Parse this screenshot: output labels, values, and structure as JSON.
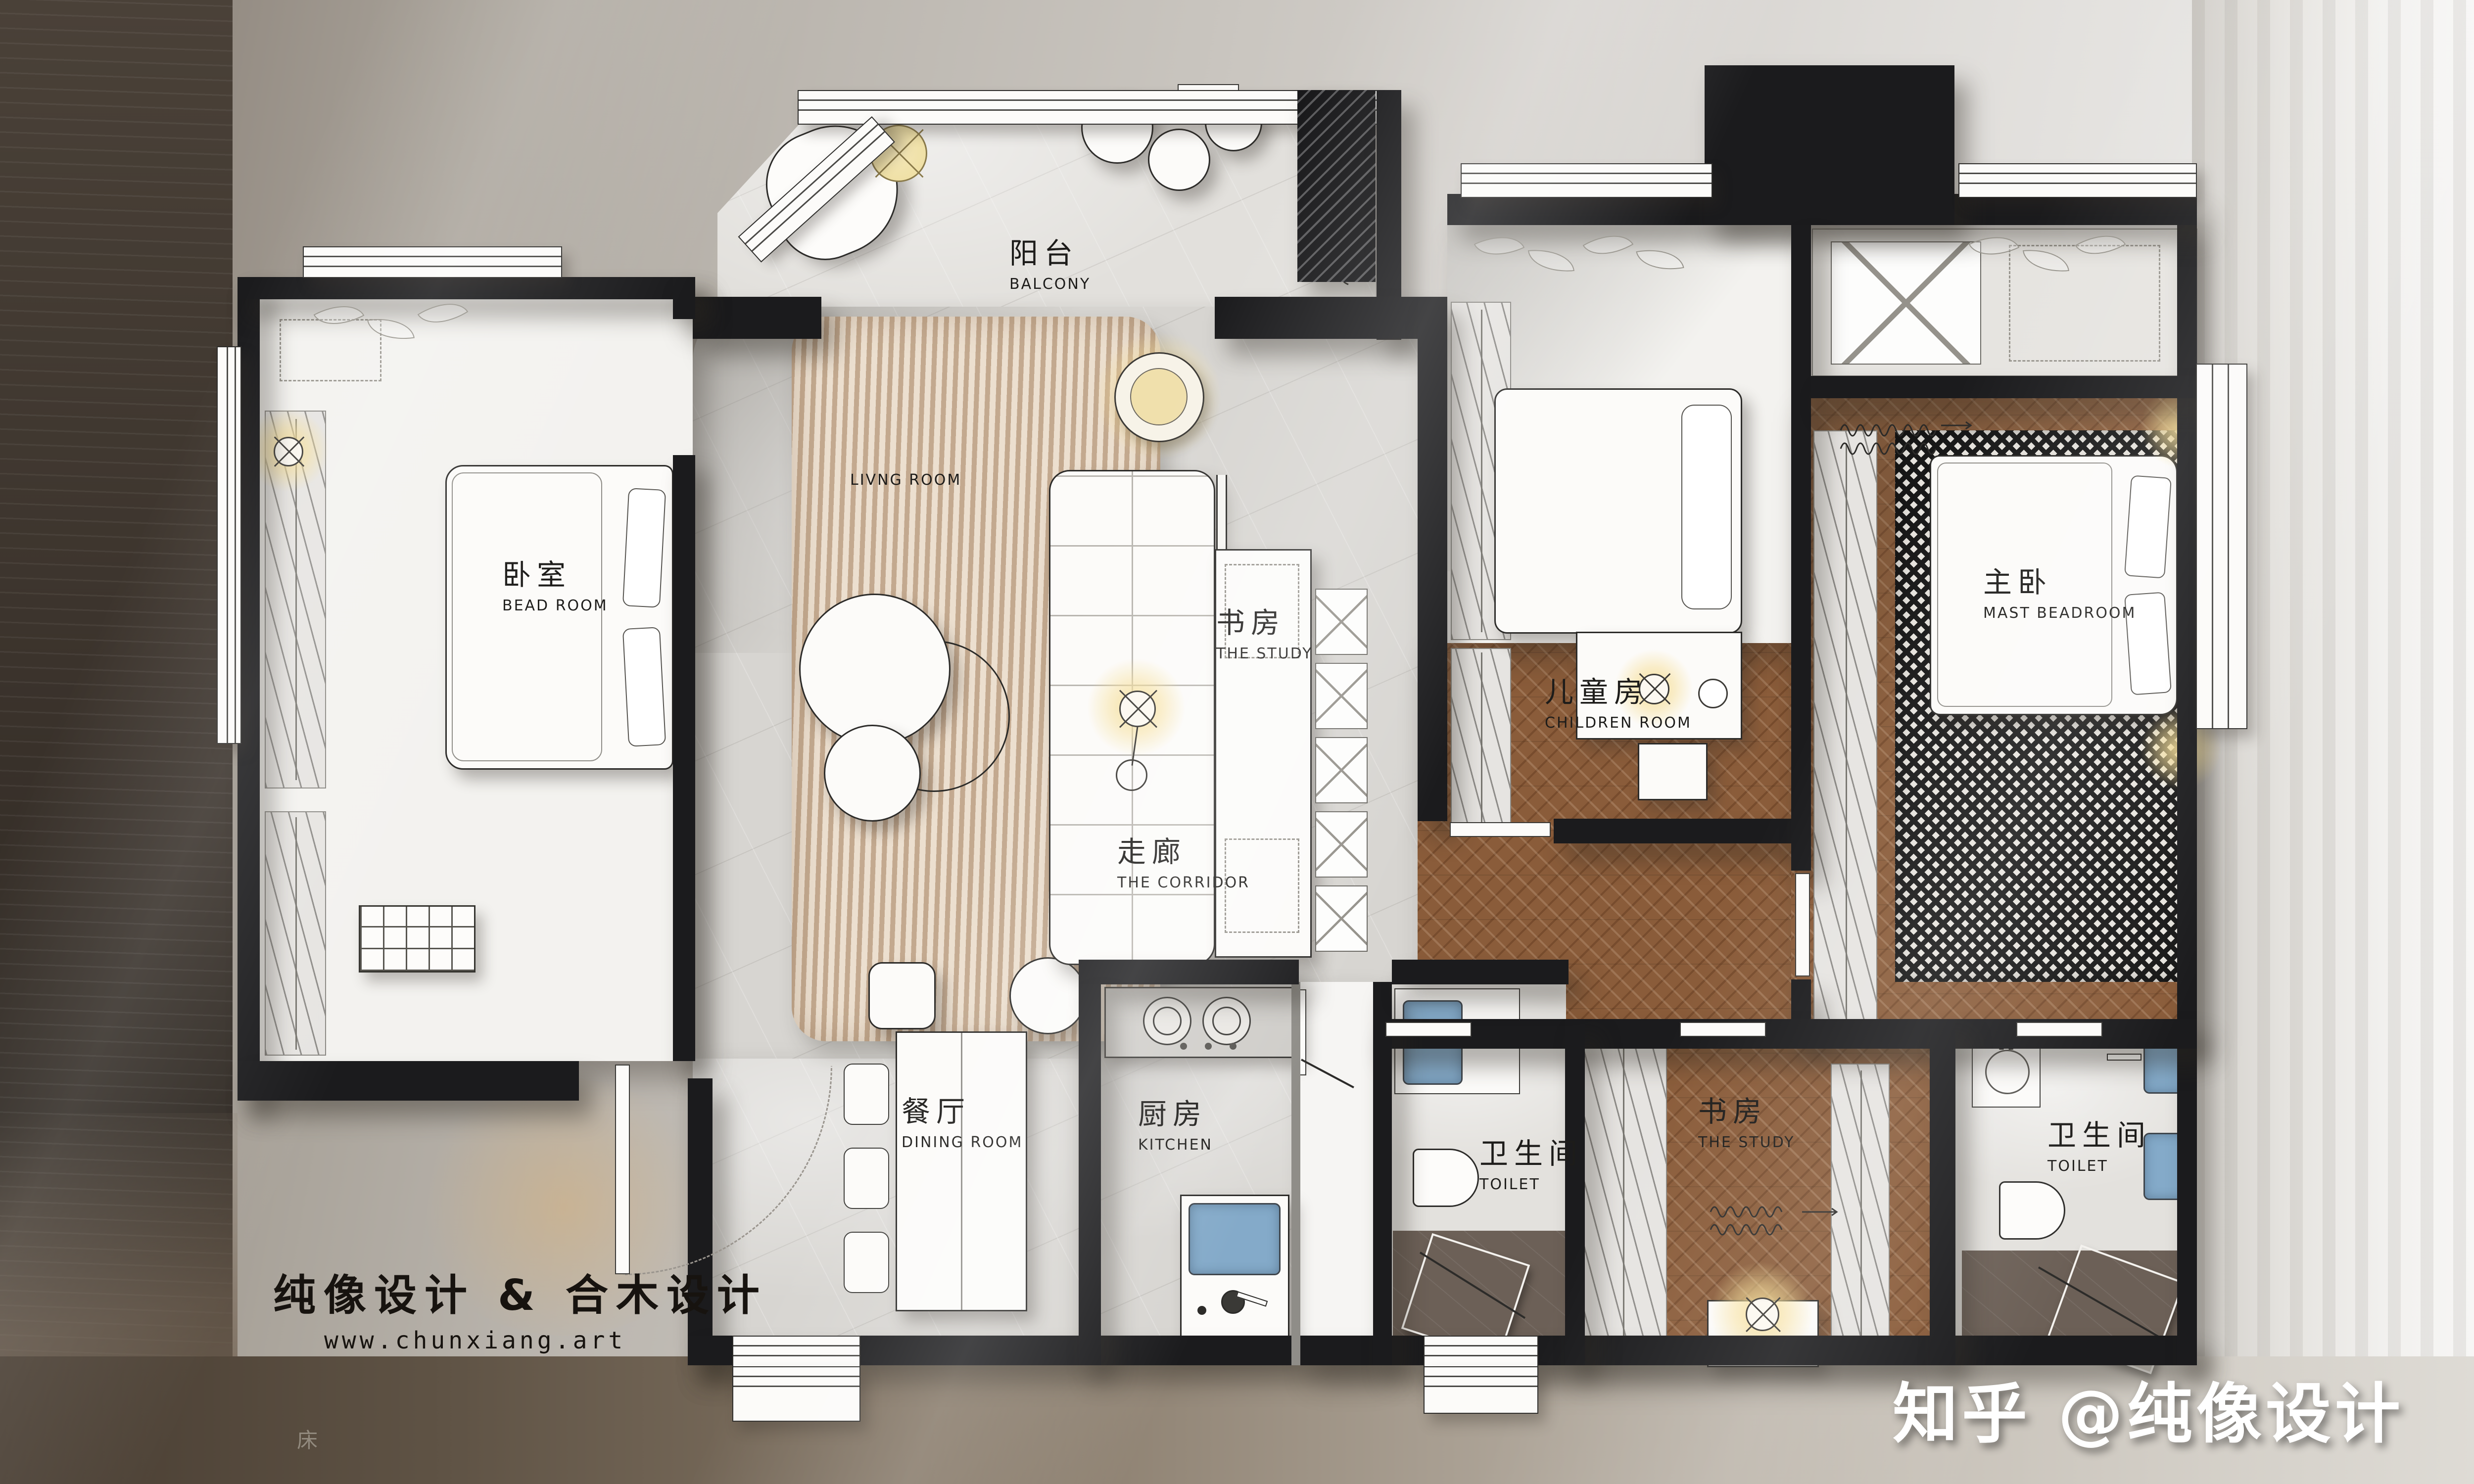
{
  "poster": {
    "brand_line": "纯像设计 & 合木设计",
    "website": "www.chunxiang.art",
    "watermark": "知乎 @纯像设计",
    "background_note": "床"
  },
  "rooms": {
    "balcony": {
      "zh": "阳台",
      "en": "BALCONY"
    },
    "bedroom": {
      "zh": "卧室",
      "en": "BEAD ROOM"
    },
    "living": {
      "zh": "",
      "en": "LIVNG ROOM"
    },
    "study_center": {
      "zh": "书房",
      "en": "THE STUDY"
    },
    "children": {
      "zh": "儿童房",
      "en": "CHILDREN ROOM"
    },
    "master": {
      "zh": "主卧",
      "en": "MAST BEADROOM"
    },
    "corridor": {
      "zh": "走廊",
      "en": "THE CORRIDOR"
    },
    "dining": {
      "zh": "餐厅",
      "en": "DINING ROOM"
    },
    "kitchen": {
      "zh": "厨房",
      "en": "KITCHEN"
    },
    "toilet_left": {
      "zh": "卫生间",
      "en": "TOILET"
    },
    "study_bottom": {
      "zh": "书房",
      "en": "THE STUDY"
    },
    "toilet_right": {
      "zh": "卫生间",
      "en": "TOILET"
    }
  },
  "fixtures": {
    "washer_label": "W"
  },
  "colors": {
    "wall": "#1b1b1d",
    "marble": "#d7d5d1",
    "wood": "#8a5c3a",
    "rug_beige": "#d8c4ae",
    "rug_bw": "#1c1c1c",
    "fixture_blue": "#84aac9",
    "light_glow": "#f3dfa4"
  }
}
